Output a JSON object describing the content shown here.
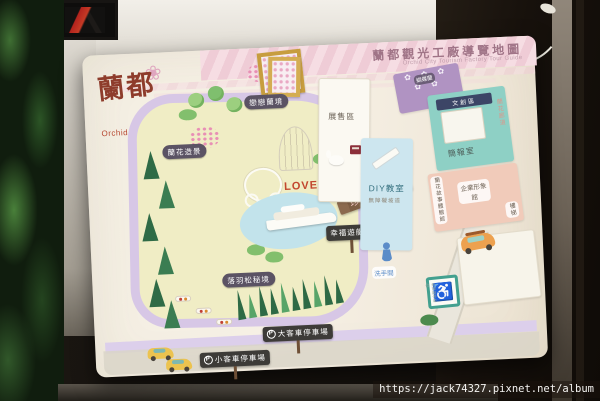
{
  "watermark": {
    "url_text": "https://jack74327.pixnet.net/album"
  },
  "board": {
    "logo": {
      "name_zh": "蘭都",
      "name_en": "Orchid City",
      "flower_icon": "❀"
    },
    "title": {
      "zh": "蘭都觀光工廠導覽地圖",
      "en": "Orchid City Tourism Factory Tour Guide"
    }
  },
  "map": {
    "badges": {
      "gate": "戀戀蘭境",
      "orchid_scenery": "蘭花造景",
      "cypress_trail": "落羽松秘境"
    },
    "love_marker": "LOVE",
    "ribbon_rare_orchids": "珍奇蘭花",
    "signs": {
      "yacht_area": "幸福遊艇區",
      "bus_parking": "大客車停車場",
      "car_parking": "小客車停車場",
      "parking_symbol": "P"
    },
    "buildings": {
      "display_area": "展售區",
      "diy_classroom": "DIY教室",
      "ramp_note": "無障礙坡道",
      "butterfly_orchid_zone": "蝴蝶蘭",
      "cultural_zone": "文創區",
      "briefing_room": "簡報室",
      "orchid_corridor": "蘭花廊道",
      "orchid_story_hall": "蘭花故事體驗館",
      "corporate_image_hall": "企業形象館",
      "stairs": "樓梯"
    },
    "amenities": {
      "restroom": "洗手間",
      "accessible_parking": "無障礙停車位",
      "wheelchair_symbol": "♿"
    },
    "street_name": "和平街"
  },
  "colors": {
    "board_bg": "#f3eee2",
    "road_lavender": "#d7c7e6",
    "park_green": "#f0edc5",
    "pond_blue": "#c2e3eb",
    "title_pink_band": "#f3d5dd",
    "badge_purple": "#5b5364",
    "logo_red": "#8e3c2b"
  }
}
